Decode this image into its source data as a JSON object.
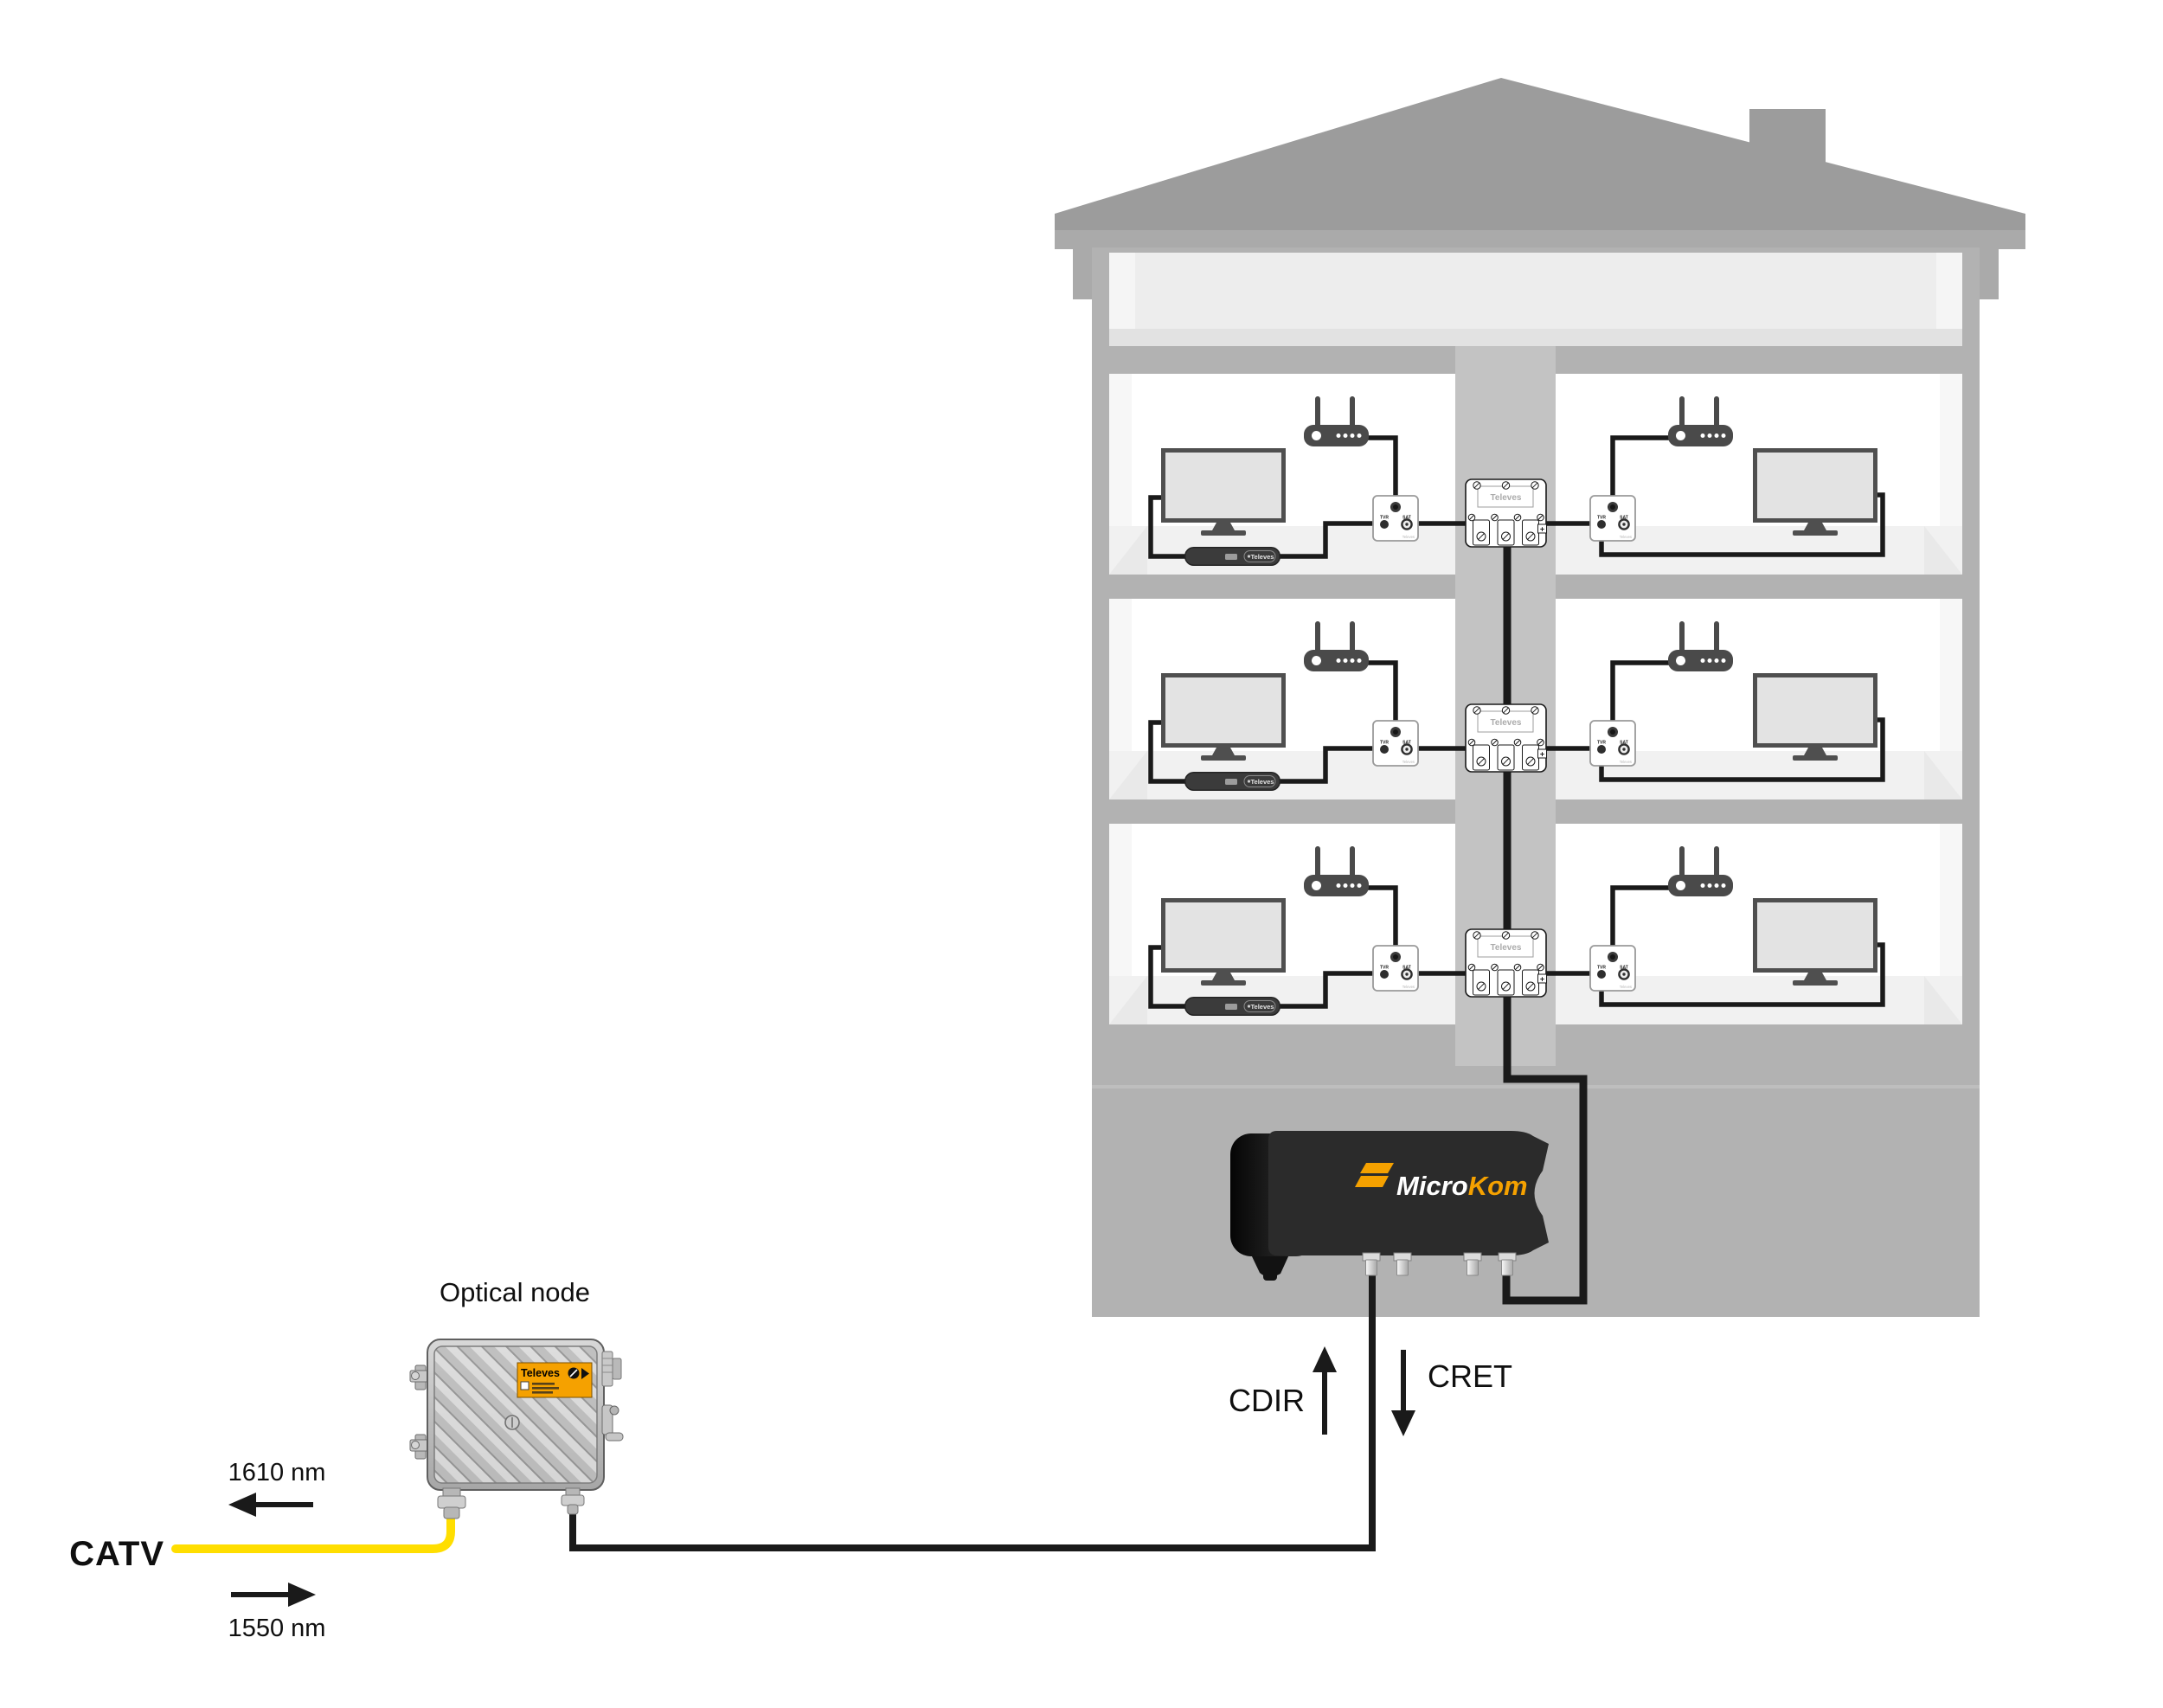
{
  "labels": {
    "optical_node": "Optical node",
    "catv": "CATV",
    "wavelength_1610": "1610 nm",
    "wavelength_1550": "1550 nm",
    "cdir": "CDIR",
    "cret": "CRET"
  },
  "brand": {
    "televes": "Televes",
    "microkom_micro": "Micro",
    "microkom_kom": "Kom"
  },
  "outlet": {
    "tv_port_label": "TVR",
    "sat_port_label": "SAT",
    "brand": "Televes"
  },
  "splitter": {
    "brand": "Televes",
    "plus": "+"
  },
  "stb": {
    "brand": "Televes"
  },
  "colors": {
    "accent_orange": "#F5A100",
    "fiber_yellow": "#FFDE00",
    "cable_black": "#1A1A1A",
    "roof_gray": "#9C9C9C",
    "wall_gray": "#B2B2B2",
    "riser_gray": "#C3C3C3",
    "room_white": "#FFFFFF",
    "platform_gray": "#F1F1F1",
    "attic_gray": "#EDEDED"
  }
}
